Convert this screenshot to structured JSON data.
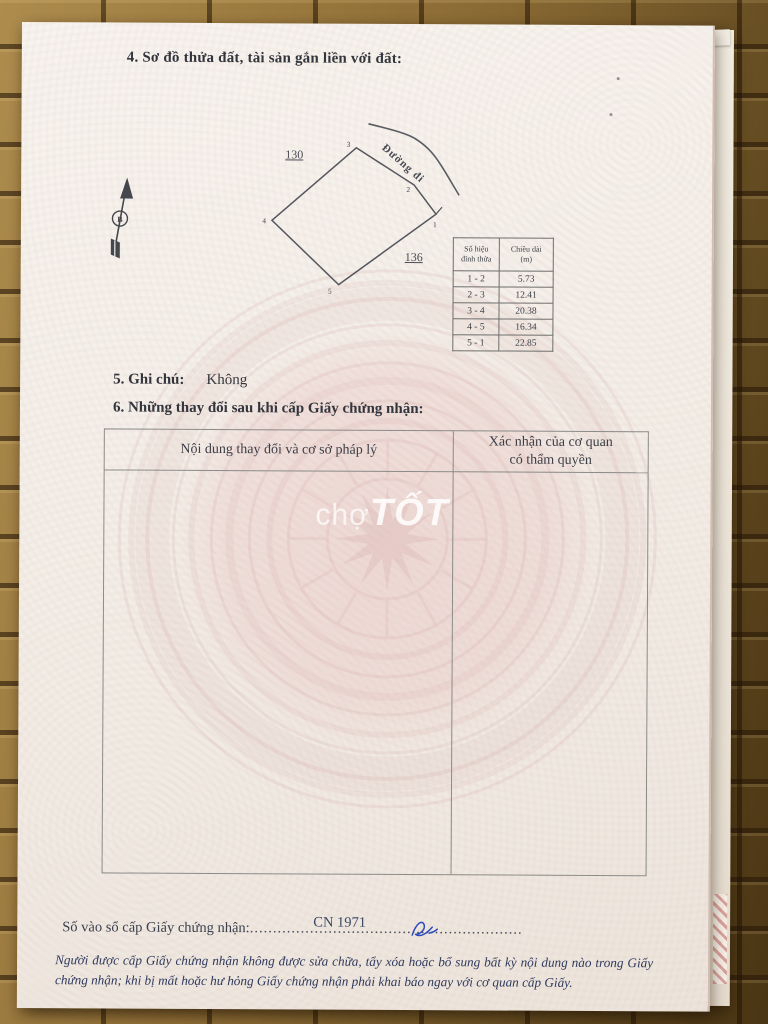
{
  "page": {
    "section4_title": "4. Sơ đồ thửa đất, tài sản gắn liền với đất:",
    "diagram": {
      "north_label": "B",
      "road_label": "Đường đi",
      "parcel_left": "130",
      "parcel_right": "136",
      "vertex_labels": [
        "1",
        "2",
        "3",
        "4",
        "5"
      ]
    },
    "edge_table": {
      "col1_header_line1": "Số hiệu",
      "col1_header_line2": "đỉnh thửa",
      "col2_header_line1": "Chiều dài",
      "col2_header_line2": "(m)",
      "rows": [
        [
          "1 - 2",
          "5.73"
        ],
        [
          "2 - 3",
          "12.41"
        ],
        [
          "3 - 4",
          "20.38"
        ],
        [
          "4 - 5",
          "16.34"
        ],
        [
          "5 - 1",
          "22.85"
        ]
      ]
    },
    "section5_label": "5. Ghi chú:",
    "section5_value": "Không",
    "section6_title": "6. Những thay đổi sau khi cấp Giấy chứng nhận:",
    "change_table": {
      "col1_header": "Nội dung thay đổi và cơ sở pháp lý",
      "col2_header_line1": "Xác nhận của cơ quan",
      "col2_header_line2": "có thẩm quyền"
    },
    "watermark": {
      "part1": "chợ",
      "part2": "TỐT"
    },
    "footer": {
      "serial_label": "Số vào sổ cấp Giấy chứng nhận:",
      "serial_dots": "...........................................................",
      "serial_value": "CN 1971",
      "notice_line1": "Người được cấp Giấy chứng nhận không được sửa chữa, tẩy xóa hoặc bổ sung bất kỳ nội dung nào trong",
      "notice_line2": "Giấy chứng nhận; khi bị mất hoặc hư hỏng Giấy chứng nhận phải khai báo ngay với cơ quan cấp Giấy."
    }
  },
  "colors": {
    "accent_pink": "#cf9a9a",
    "ink": "#3a3d46",
    "notice_blue": "#2f3a5e",
    "pen_blue": "#2b4bbf",
    "wood_brown": "#8a6a34"
  }
}
